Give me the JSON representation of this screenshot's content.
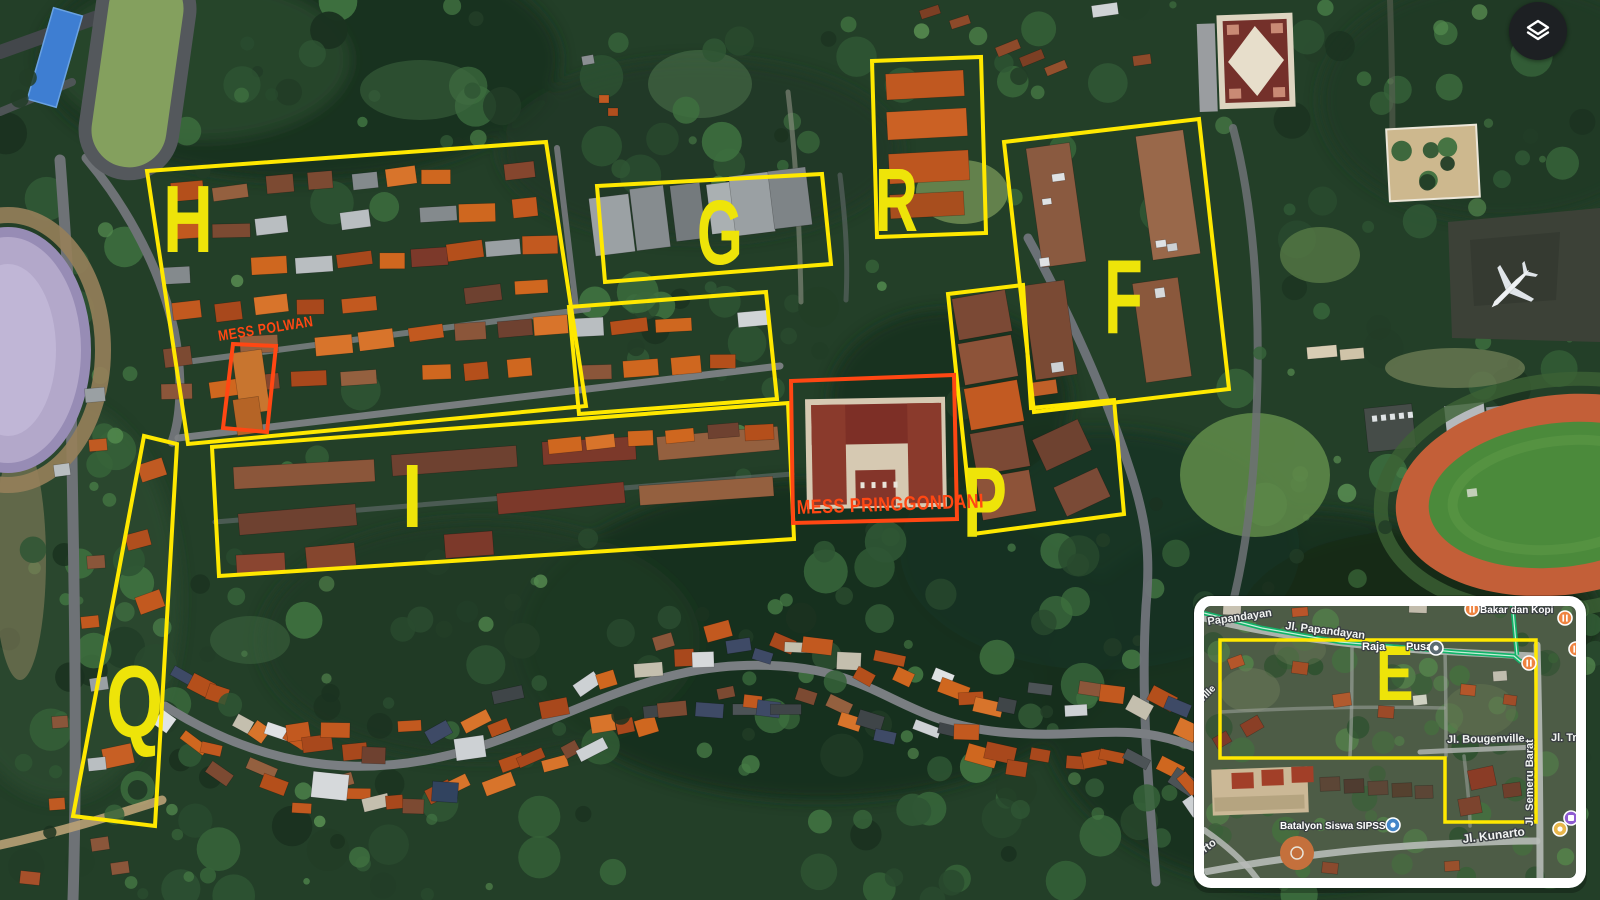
{
  "colors": {
    "region": "#ffe800",
    "letter": "#eee409",
    "highlight": "#ff4713",
    "route": "#12b369",
    "inset_frame": "#ffffff"
  },
  "controls": {
    "layers_button": "layers"
  },
  "regions": [
    {
      "letter": "H",
      "outline": [
        [
          147,
          171
        ],
        [
          546,
          142
        ],
        [
          586,
          406
        ],
        [
          188,
          444
        ]
      ],
      "letter_pos": [
        163,
        252
      ],
      "size": 96,
      "sx": 0.72
    },
    {
      "letter": "G",
      "outline": [
        [
          597,
          186
        ],
        [
          822,
          174
        ],
        [
          831,
          264
        ],
        [
          605,
          282
        ]
      ],
      "letter_pos": [
        697,
        264
      ],
      "size": 92,
      "sx": 0.64
    },
    {
      "letter": "R",
      "outline": [
        [
          872,
          61
        ],
        [
          981,
          57
        ],
        [
          986,
          233
        ],
        [
          877,
          237
        ]
      ],
      "letter_pos": [
        875,
        231
      ],
      "size": 90,
      "sx": 0.66
    },
    {
      "letter": "F",
      "outline": [
        [
          1004,
          142
        ],
        [
          1199,
          119
        ],
        [
          1229,
          389
        ],
        [
          1034,
          412
        ]
      ],
      "letter_pos": [
        1104,
        333
      ],
      "size": 106,
      "sx": 0.6
    },
    {
      "letter": "",
      "outline": [
        [
          569,
          307
        ],
        [
          766,
          292
        ],
        [
          777,
          399
        ],
        [
          579,
          414
        ]
      ],
      "letter_pos": [
        0,
        0
      ],
      "size": 0,
      "sx": 1
    },
    {
      "letter": "I",
      "outline": [
        [
          212,
          447
        ],
        [
          788,
          403
        ],
        [
          794,
          539
        ],
        [
          219,
          576
        ]
      ],
      "letter_pos": [
        402,
        527
      ],
      "size": 90,
      "sx": 0.82
    },
    {
      "letter": "P",
      "outline": [
        [
          948,
          294
        ],
        [
          1023,
          285
        ],
        [
          1031,
          408
        ],
        [
          1114,
          400
        ],
        [
          1124,
          514
        ],
        [
          973,
          534
        ]
      ],
      "letter_pos": [
        963,
        537
      ],
      "size": 100,
      "sx": 0.66
    },
    {
      "letter": "Q",
      "outline": [
        [
          144,
          436
        ],
        [
          177,
          444
        ],
        [
          155,
          826
        ],
        [
          73,
          816
        ]
      ],
      "letter_pos": [
        106,
        737
      ],
      "size": 102,
      "sx": 0.72
    }
  ],
  "highlights": [
    {
      "label": "MESS POLWAN",
      "outline": [
        [
          233,
          344
        ],
        [
          276,
          346
        ],
        [
          267,
          432
        ],
        [
          223,
          428
        ]
      ],
      "label_pos": [
        219,
        341
      ],
      "rot": -9,
      "size": 15
    },
    {
      "label": "MESS PRINGGONDANI",
      "outline": [
        [
          791,
          381
        ],
        [
          954,
          375
        ],
        [
          957,
          519
        ],
        [
          793,
          523
        ]
      ],
      "label_pos": [
        797,
        514
      ],
      "rot": -2,
      "size": 20
    }
  ],
  "inset": {
    "region_letter": "E",
    "letter_pos": [
      1376,
      700
    ],
    "letter_size": 78,
    "letter_sx": 0.72,
    "e_outline": [
      [
        1220,
        640
      ],
      [
        1536,
        640
      ],
      [
        1536,
        822
      ],
      [
        1445,
        822
      ],
      [
        1445,
        758
      ],
      [
        1220,
        758
      ]
    ],
    "streets": [
      {
        "text": "Papandayan",
        "pos": [
          1208,
          625
        ],
        "rot": -8,
        "size": 11
      },
      {
        "text": "Jl. Papandayan",
        "pos": [
          1285,
          629
        ],
        "rot": 7,
        "size": 11
      },
      {
        "text": "Jl. Bougenville",
        "pos": [
          1447,
          743
        ],
        "rot": -1,
        "size": 11
      },
      {
        "text": "Jl. Tri",
        "pos": [
          1551,
          741
        ],
        "rot": 0,
        "size": 11
      },
      {
        "text": "Jl. Semeru Barat",
        "pos": [
          1533,
          826
        ],
        "rot": -90,
        "size": 11
      },
      {
        "text": "Jl. Kunarto",
        "pos": [
          1463,
          843
        ],
        "rot": -7,
        "size": 12
      },
      {
        "text": "nville",
        "pos": [
          1198,
          707
        ],
        "rot": -45,
        "size": 10
      },
      {
        "text": "orto",
        "pos": [
          1200,
          857
        ],
        "rot": -38,
        "size": 11
      }
    ],
    "places": [
      {
        "text": "Bakar dan Kopi",
        "pos": [
          1480,
          613
        ],
        "size": 10
      },
      {
        "text": "Raja",
        "pos": [
          1362,
          650
        ],
        "size": 11
      },
      {
        "text": "Pusat",
        "pos": [
          1406,
          650
        ],
        "size": 11
      },
      {
        "text": "Batalyon Siswa SIPSS",
        "pos": [
          1280,
          829
        ],
        "size": 10
      }
    ],
    "icons": [
      {
        "type": "restaurant",
        "x": 1565,
        "y": 618
      },
      {
        "type": "restaurant",
        "x": 1576,
        "y": 649
      },
      {
        "type": "restaurant",
        "x": 1529,
        "y": 663
      },
      {
        "type": "restaurant",
        "x": 1472,
        "y": 609
      },
      {
        "type": "transit",
        "x": 1436,
        "y": 648
      },
      {
        "type": "place-blue",
        "x": 1393,
        "y": 825
      },
      {
        "type": "lodging",
        "x": 1571,
        "y": 818
      },
      {
        "type": "place-yellow",
        "x": 1560,
        "y": 829
      }
    ]
  }
}
